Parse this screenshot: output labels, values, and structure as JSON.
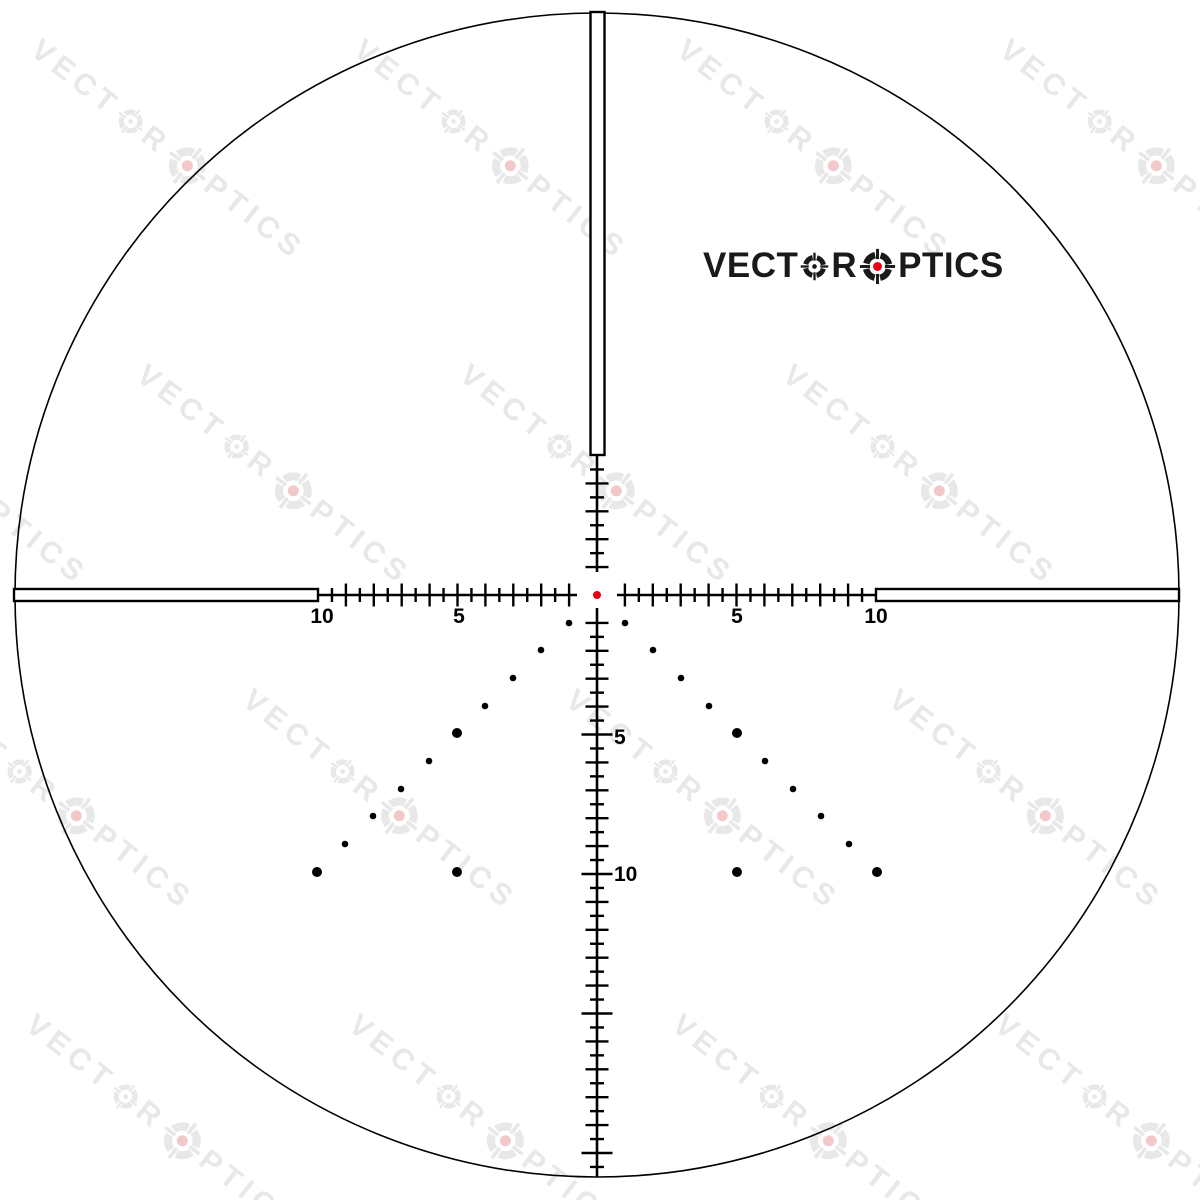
{
  "page": {
    "background": "#ffffff"
  },
  "logo": {
    "part1": "VECT",
    "part2": "R",
    "part3": "PTICS",
    "full_text": "VECTOR OPTICS",
    "color": "#1a1a1a",
    "red": "#e60012",
    "x": 703,
    "y": 246,
    "font_px": 35
  },
  "watermark": {
    "part1": "VECT",
    "part2": "R",
    "part3": "PTICS",
    "full_text": "VECTOR OPTICS",
    "color": "#e8e8e8",
    "red_tint": "#f3c8c8",
    "angle_deg": 38,
    "font_px": 30,
    "letter_spacing": 6,
    "anchor_dx": -192,
    "anchor_dy": -21,
    "anchors": [
      [
        187,
        163
      ],
      [
        510,
        163
      ],
      [
        833,
        163
      ],
      [
        1156,
        163
      ],
      [
        -30,
        488
      ],
      [
        293,
        488
      ],
      [
        616,
        488
      ],
      [
        939,
        488
      ],
      [
        76,
        813
      ],
      [
        399,
        813
      ],
      [
        722,
        813
      ],
      [
        1045,
        813
      ],
      [
        182,
        1138
      ],
      [
        505,
        1138
      ],
      [
        828,
        1138
      ],
      [
        1151,
        1138
      ]
    ]
  },
  "reticle": {
    "color": "#000000",
    "red": "#e60012",
    "center": {
      "x": 597,
      "y": 595
    },
    "mil_px": 27.9,
    "circle": {
      "r": 582,
      "stroke": 1.6
    },
    "center_dot_r": 4,
    "posts": {
      "stroke": 2.4,
      "top": {
        "x1": 590.5,
        "y1": 12,
        "x2": 604.5,
        "y2": 455
      },
      "left": {
        "x1": 14,
        "y1": 589,
        "x2": 318,
        "y2": 601
      },
      "right": {
        "x1": 876,
        "y1": 589,
        "x2": 1179,
        "y2": 601
      }
    },
    "lines": {
      "stroke": 2.6,
      "h_left": {
        "x1": 318,
        "y1": 595,
        "x2": 577,
        "y2": 595
      },
      "h_right": {
        "x1": 617,
        "y1": 595,
        "x2": 876,
        "y2": 595
      },
      "v_top": {
        "x1": 597,
        "y1": 455,
        "x2": 597,
        "y2": 572
      },
      "v_bottom": {
        "x1": 597,
        "y1": 608,
        "x2": 597,
        "y2": 1177
      }
    },
    "ticks": {
      "stroke": 2.4,
      "half_len": 7,
      "mil_len": 11.5,
      "five_len": 15.5,
      "h_max_mil": 9.5,
      "v_up_max_mil": 4.5,
      "v_down_max_mil": 20.5,
      "step_mil": 0.5
    },
    "labels": {
      "font_px": 21,
      "items": [
        {
          "text": "10",
          "x": 322,
          "y": 623,
          "anchor": "middle"
        },
        {
          "text": "5",
          "x": 459,
          "y": 623,
          "anchor": "middle"
        },
        {
          "text": "5",
          "x": 737,
          "y": 623,
          "anchor": "middle"
        },
        {
          "text": "10",
          "x": 876,
          "y": 623,
          "anchor": "middle"
        },
        {
          "text": "5",
          "x": 614,
          "y": 744,
          "anchor": "start"
        },
        {
          "text": "10",
          "x": 614,
          "y": 881,
          "anchor": "start"
        }
      ]
    },
    "dots": {
      "r_small": 3.3,
      "r_big": 5,
      "items": [
        [
          569,
          623,
          0
        ],
        [
          625,
          623,
          0
        ],
        [
          541,
          650,
          0
        ],
        [
          653,
          650,
          0
        ],
        [
          513,
          678,
          0
        ],
        [
          681,
          678,
          0
        ],
        [
          485,
          706,
          0
        ],
        [
          709,
          706,
          0
        ],
        [
          457,
          733,
          1
        ],
        [
          737,
          733,
          1
        ],
        [
          429,
          761,
          0
        ],
        [
          765,
          761,
          0
        ],
        [
          401,
          789,
          0
        ],
        [
          793,
          789,
          0
        ],
        [
          373,
          816,
          0
        ],
        [
          821,
          816,
          0
        ],
        [
          345,
          844,
          0
        ],
        [
          849,
          844,
          0
        ],
        [
          317,
          872,
          1
        ],
        [
          877,
          872,
          1
        ],
        [
          457,
          872,
          1
        ],
        [
          737,
          872,
          1
        ]
      ]
    }
  }
}
